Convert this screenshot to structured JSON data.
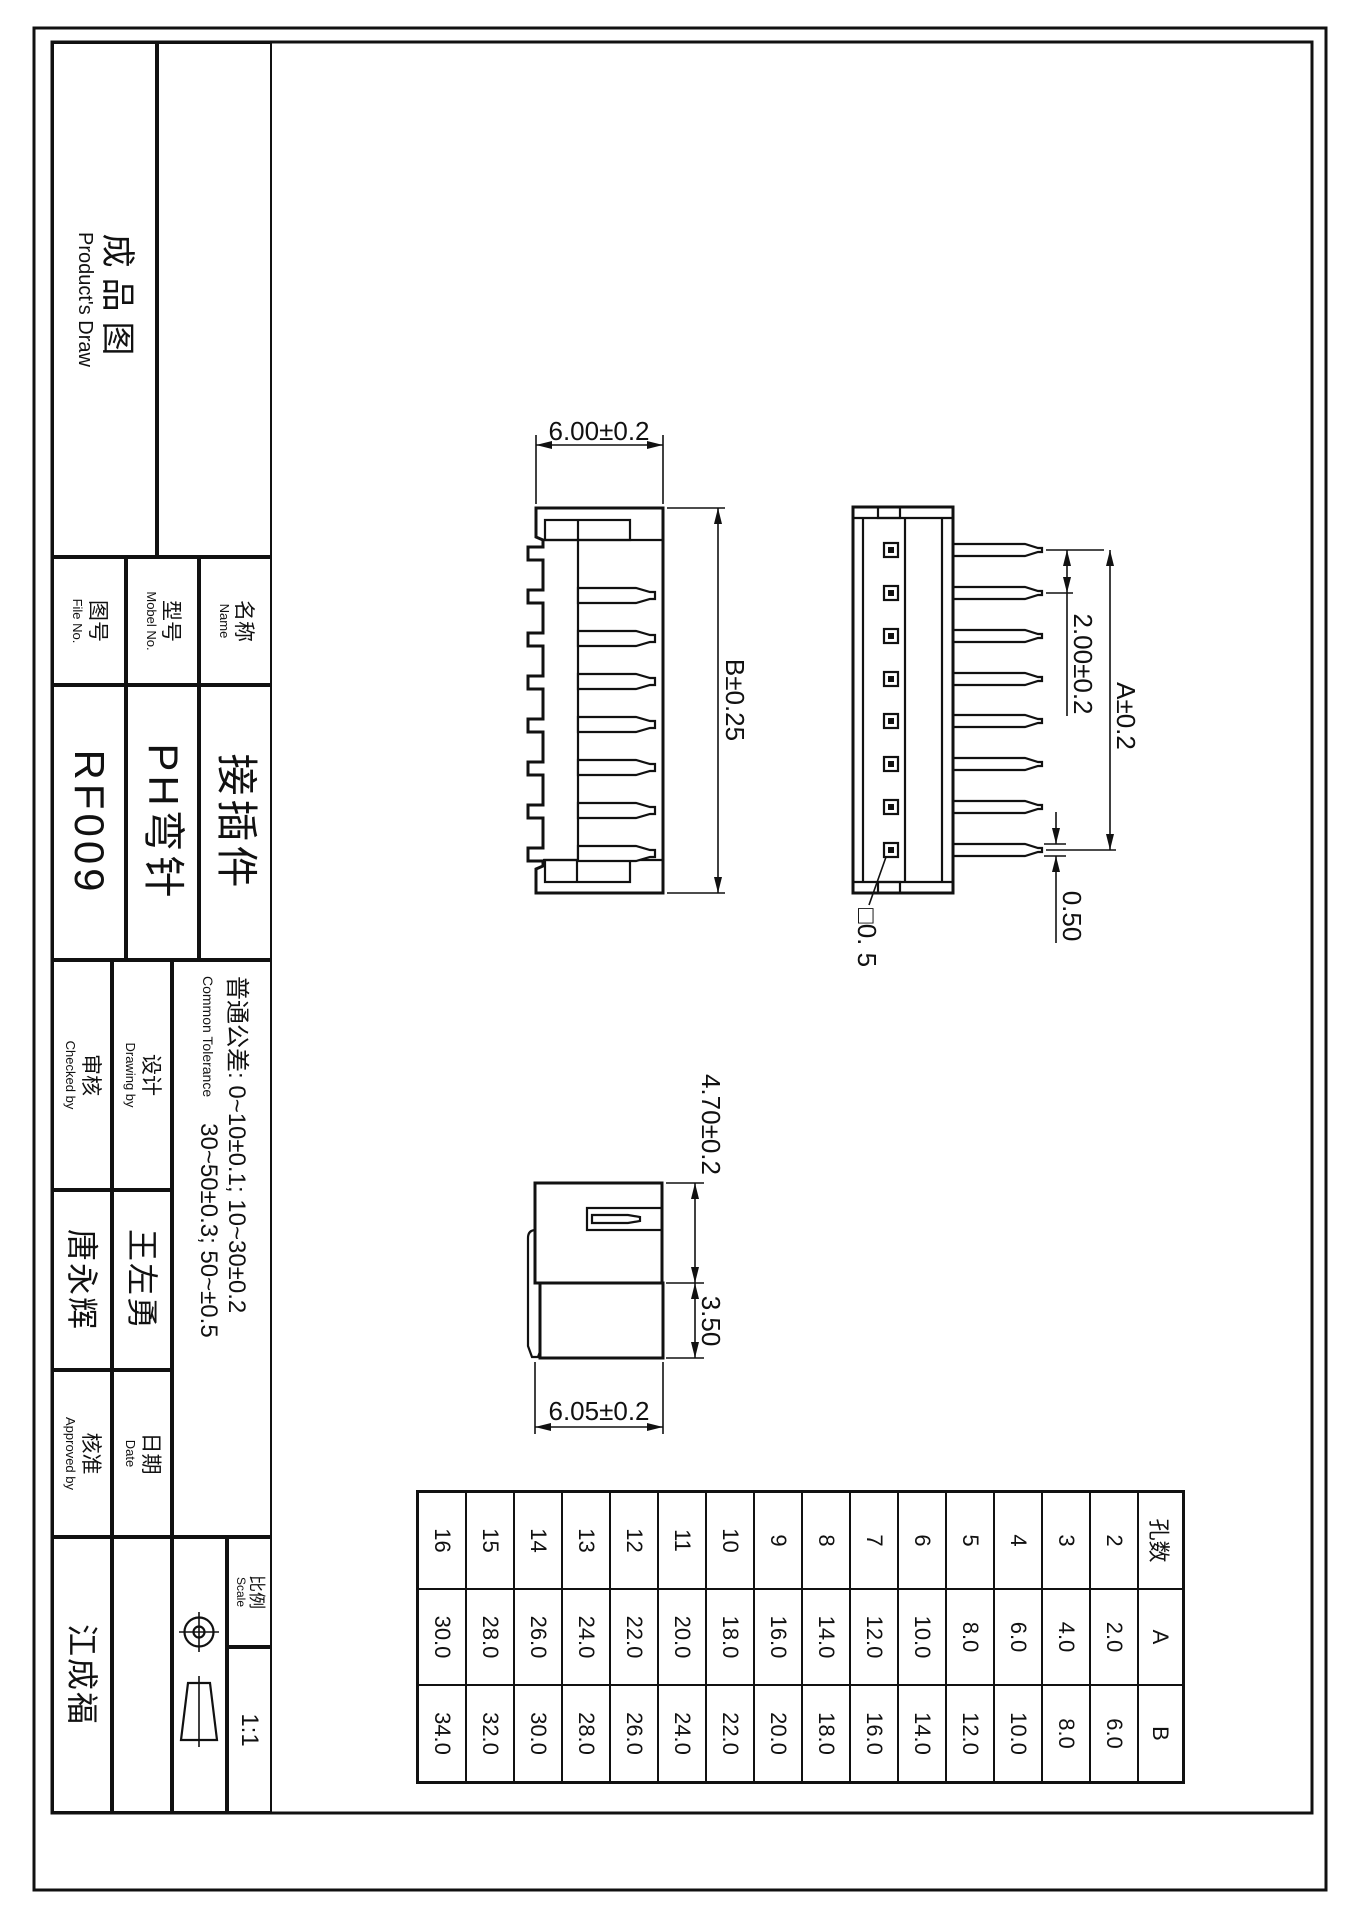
{
  "sheet": {
    "product_draw_cn": "成品图",
    "product_draw_en": "Product's Draw"
  },
  "title_block": {
    "name_label_cn": "名称",
    "name_label_en": "Name",
    "name_value": "接插件",
    "model_label_cn": "型号",
    "model_label_en": "Mobel No.",
    "model_value": "PH弯针",
    "file_label_cn": "图号",
    "file_label_en": "File No.",
    "file_value": "RF009",
    "tolerance_cn": "普通公差:",
    "tolerance_en": "Common Tolerance",
    "tolerance_line1": "0~10±0.1; 10~30±0.2",
    "tolerance_line2": "30~50±0.3; 50~±0.5",
    "drawing_by_cn": "设计",
    "drawing_by_en": "Drawing by",
    "drawing_by_value": "王左勇",
    "checked_by_cn": "审核",
    "checked_by_en": "Checked by",
    "checked_by_value": "唐永辉",
    "date_cn": "日期",
    "date_en": "Date",
    "approved_by_cn": "核准",
    "approved_by_en": "Approved by",
    "approved_by_value": "江成福",
    "scale_cn": "比例",
    "scale_en": "Scale",
    "scale_value": "1:1"
  },
  "dimensions": {
    "top_view_depth": "6.00±0.2",
    "top_view_length": "B±0.25",
    "pin_pitch": "2.00±0.2",
    "pin_span": "A±0.2",
    "pin_thickness": "0.50",
    "pin_square": "□0. 5",
    "side_height": "4.70±0.2",
    "side_pin_drop": "3.50",
    "side_depth": "6.05±0.2"
  },
  "pin_table": {
    "headers": [
      "孔数",
      "A",
      "B"
    ],
    "rows": [
      [
        "2",
        "2.0",
        "6.0"
      ],
      [
        "3",
        "4.0",
        "8.0"
      ],
      [
        "4",
        "6.0",
        "10.0"
      ],
      [
        "5",
        "8.0",
        "12.0"
      ],
      [
        "6",
        "10.0",
        "14.0"
      ],
      [
        "7",
        "12.0",
        "16.0"
      ],
      [
        "8",
        "14.0",
        "18.0"
      ],
      [
        "9",
        "16.0",
        "20.0"
      ],
      [
        "10",
        "18.0",
        "22.0"
      ],
      [
        "11",
        "20.0",
        "24.0"
      ],
      [
        "12",
        "22.0",
        "26.0"
      ],
      [
        "13",
        "24.0",
        "28.0"
      ],
      [
        "14",
        "26.0",
        "30.0"
      ],
      [
        "15",
        "28.0",
        "32.0"
      ],
      [
        "16",
        "30.0",
        "34.0"
      ]
    ]
  }
}
